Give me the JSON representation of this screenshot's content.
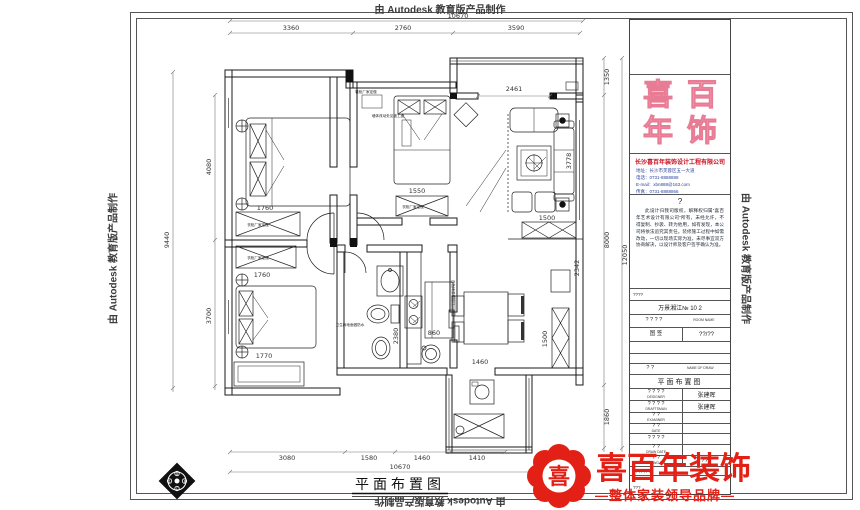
{
  "watermark": {
    "text": "由 Autodesk 教育版产品制作"
  },
  "plan": {
    "title": "平面布置图",
    "dims": {
      "top_total": "10670",
      "top_a": "3360",
      "top_b": "2760",
      "top_c": "3590",
      "left_total": "9440",
      "left_a": "4080",
      "left_b": "3700",
      "right_total": "12050",
      "right_a": "1350",
      "right_b": "8000",
      "right_c": "1860",
      "bottom_total": "10670",
      "bottom_a": "3080",
      "bottom_b": "1580",
      "bottom_c": "1460",
      "bottom_d": "1410",
      "opening": "2461",
      "living_depth": "3778",
      "sofa_row": "1500",
      "cabinet": "1500",
      "column": "2342",
      "bath": "2380",
      "wardrobe_master": "1760",
      "wardrobe_bed2": "1550",
      "wardrobe_bed3": "1760",
      "bed3_width": "1770",
      "stove": "860",
      "balcony_top": "1460"
    },
    "notes": {
      "shoe_cabinet": "鞋柜厂家定做",
      "wall_change": "墙体改动处见施工图",
      "wardrobe": "衣柜厂家定做",
      "waterproof": "卫生间地面做防水",
      "sliding_door": "白色烤漆推拉门"
    }
  },
  "compass": {
    "n": "A",
    "e": "B",
    "s": "C",
    "w": "D"
  },
  "title_block": {
    "logo": {
      "c1": "喜",
      "c2": "百",
      "c3": "年",
      "c4": "饰"
    },
    "company": {
      "name": "长沙喜百年装饰设计工程有限公司",
      "addr": "地址：长沙市芙蓉区五一大道",
      "tel": "电话：0731-8888888",
      "email": "E-mail：xbn888@163.com",
      "fax": "传真：0731-8888866"
    },
    "notice": {
      "mark": "?",
      "body": "此设计归我司版权，解释权归属“喜百年艺术设计有限公司”所有，未经允许，不得复制、抄袭、转为他用，如有发现，本公司将依法追究其责任。装修施工过程中如需改动，一切以现场实际为准，未尽事宜双方协商解决，以设计师及客户签字确认为准。"
    },
    "table": {
      "r1": "????",
      "project": "万景湘江№ 10 2",
      "room_zh": "? ? ? ?",
      "room_en": "ROOM NAME",
      "sheet_zh": "图 签",
      "sheet_val": "??/??",
      "name_zh": "? ?",
      "name_en": "NAME OF DRAW",
      "draw_name": "平面布置图",
      "rows": [
        {
          "zh": "? ? ? ?",
          "en": "DESIGNER",
          "val": "张建晖"
        },
        {
          "zh": "? ? ? ?",
          "en": "DRAFTSMAN",
          "val": "张建晖"
        },
        {
          "zh": "? ?",
          "en": "EXAMINER",
          "val": ""
        },
        {
          "zh": "? ?",
          "en": "DATE",
          "val": ""
        },
        {
          "zh": "? ? ? ?",
          "en": "",
          "val": ""
        },
        {
          "zh": "? ?",
          "en": "DRAW DATE",
          "val": ""
        },
        {
          "zh": "? ?",
          "en": "DRAWG NO.",
          "val": "??1"
        }
      ],
      "footer1": "????????",
      "footer2": "???"
    }
  },
  "brand": {
    "seal_char": "喜",
    "name": "喜百年装饰",
    "tagline": "—整体家装领导品牌—",
    "color": "#e32015"
  }
}
